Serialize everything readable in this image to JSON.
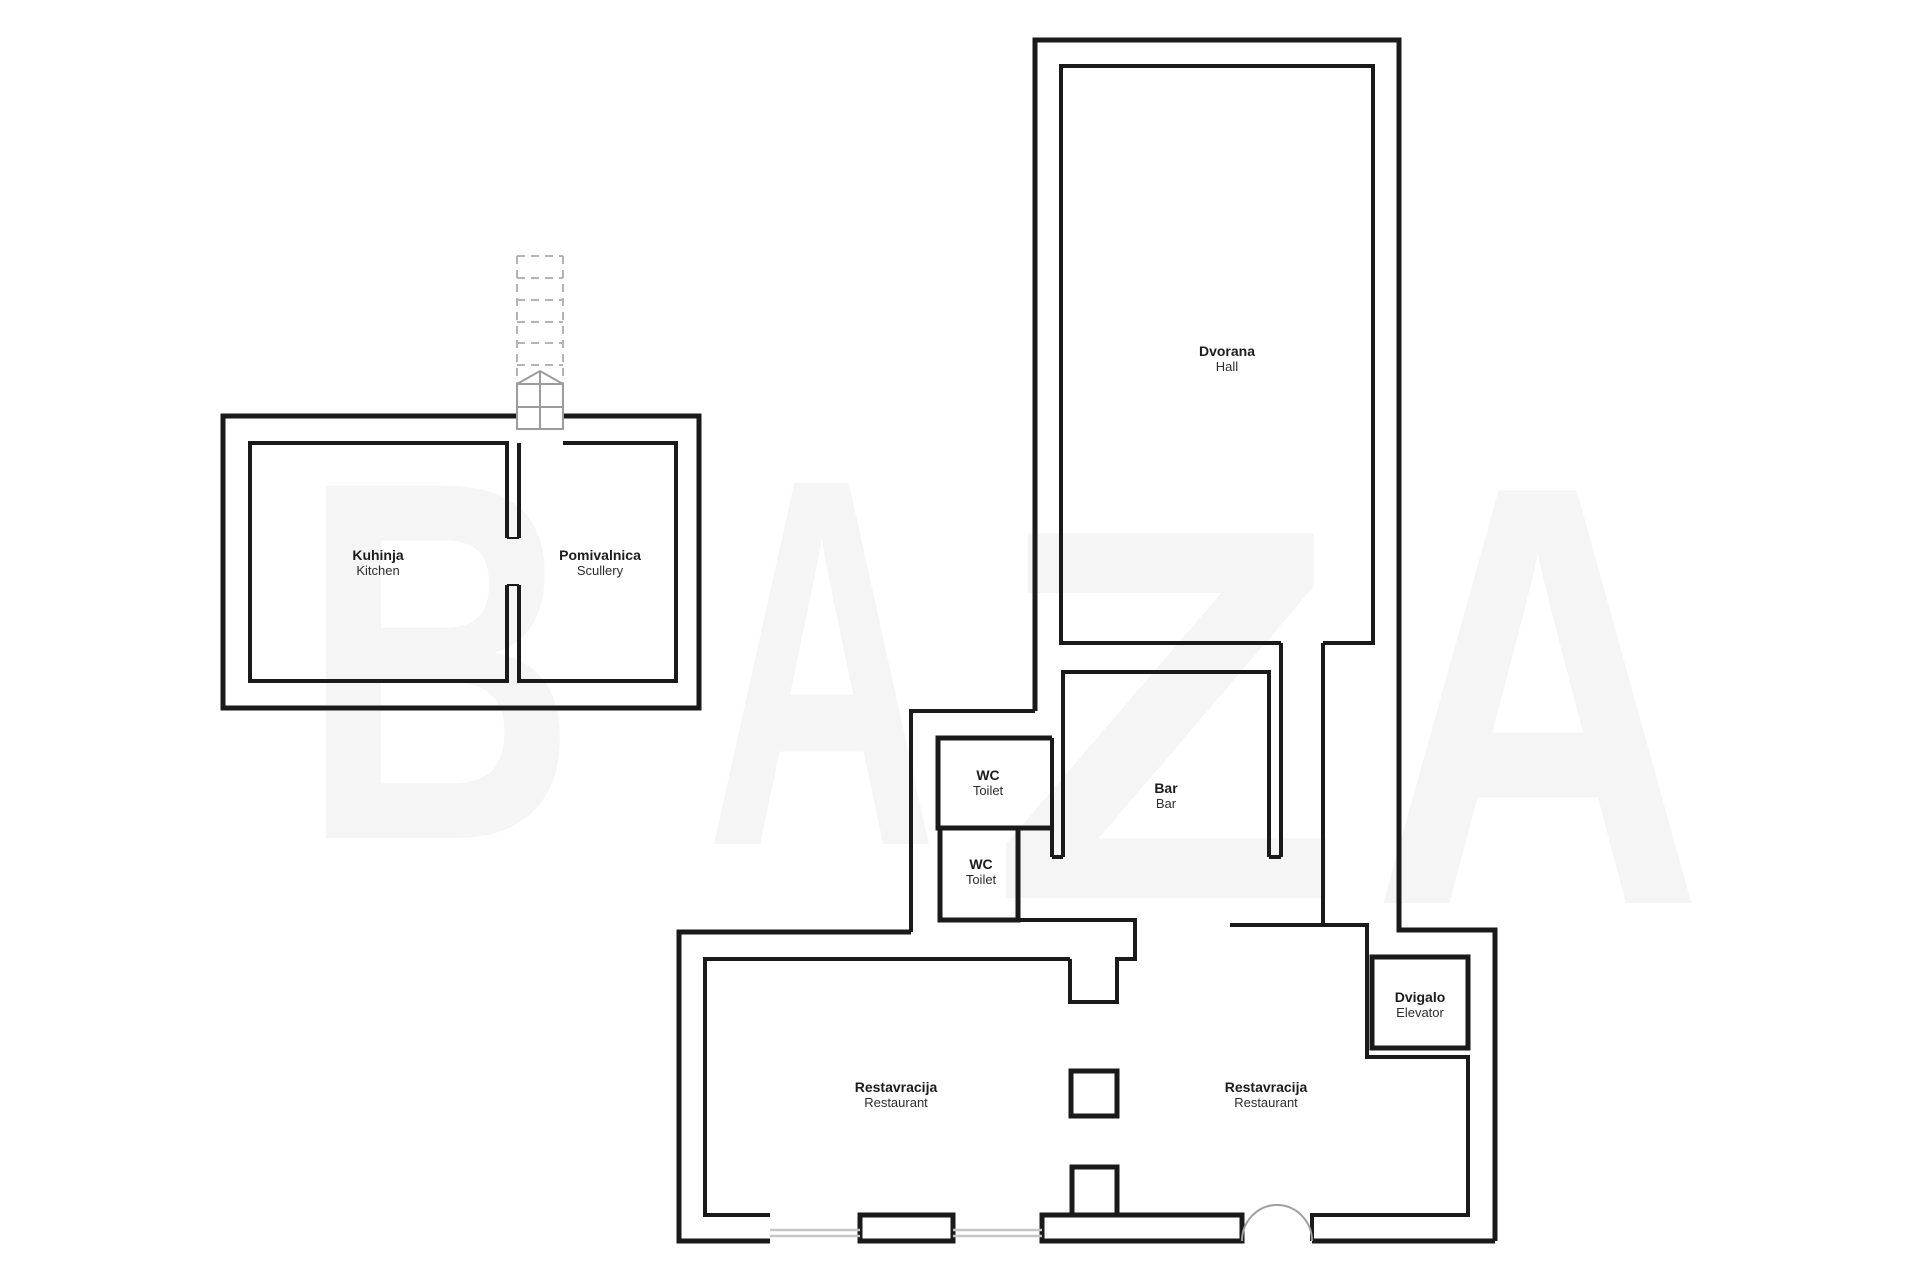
{
  "watermark": {
    "letters": [
      "B",
      "A",
      "Z",
      "A"
    ],
    "color": "#f5f5f5"
  },
  "rooms": [
    {
      "id": "kitchen",
      "label": "Kuhinja",
      "sublabel": "Kitchen"
    },
    {
      "id": "scullery",
      "label": "Pomivalnica",
      "sublabel": "Scullery"
    },
    {
      "id": "hall",
      "label": "Dvorana",
      "sublabel": "Hall"
    },
    {
      "id": "wc-upper",
      "label": "WC",
      "sublabel": "Toilet"
    },
    {
      "id": "wc-lower",
      "label": "WC",
      "sublabel": "Toilet"
    },
    {
      "id": "bar",
      "label": "Bar",
      "sublabel": "Bar"
    },
    {
      "id": "restaurant-left",
      "label": "Restavracija",
      "sublabel": "Restaurant"
    },
    {
      "id": "restaurant-right",
      "label": "Restavracija",
      "sublabel": "Restaurant"
    },
    {
      "id": "elevator",
      "label": "Dvigalo",
      "sublabel": "Elevator"
    }
  ],
  "colors": {
    "wall": "#1a1a1a",
    "stair_dash": "#b4b4b4",
    "stair_solid": "#9c9c9c",
    "window": "#c5c5c5",
    "door_arc": "#a0a0a0"
  }
}
